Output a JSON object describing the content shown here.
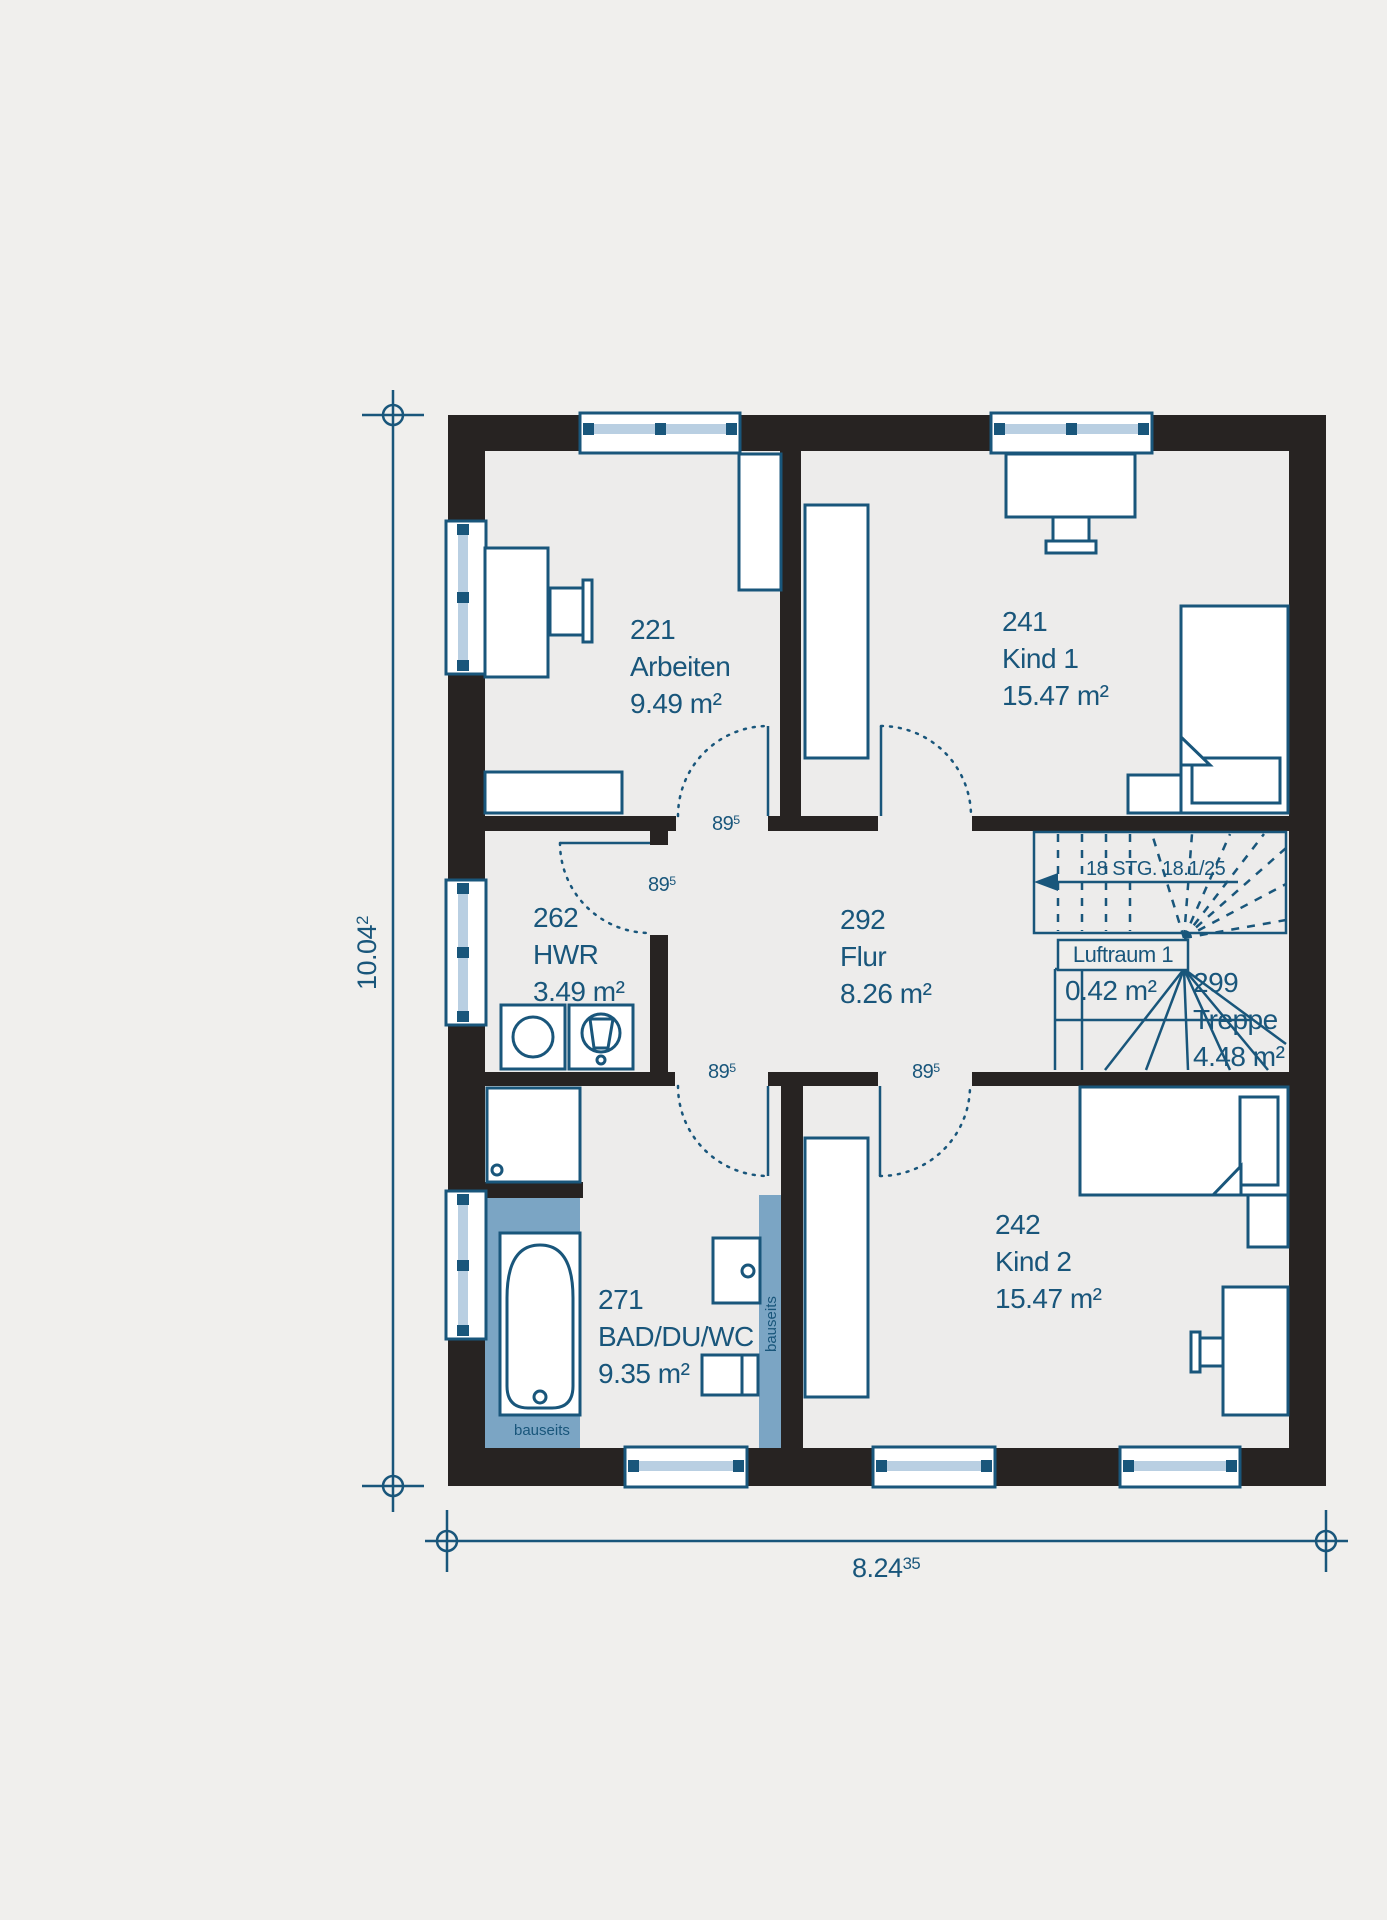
{
  "colors": {
    "accent_blue": "#19567b",
    "wall_black": "#272322",
    "window_glass": "#b9cfe2",
    "bauseits_blue": "#7ba5c4",
    "background": "#f0efed",
    "floor": "#edeceb"
  },
  "rooms": {
    "arbeiten": {
      "number": "221",
      "name": "Arbeiten",
      "area": "9.49 m²"
    },
    "kind1": {
      "number": "241",
      "name": "Kind 1",
      "area": "15.47 m²"
    },
    "hwr": {
      "number": "262",
      "name": "HWR",
      "area": "3.49 m²"
    },
    "flur": {
      "number": "292",
      "name": "Flur",
      "area": "8.26 m²"
    },
    "treppe": {
      "number": "299",
      "name": "Treppe",
      "area": "4.48 m²"
    },
    "bad": {
      "number": "271",
      "name": "BAD/DU/WC",
      "area": "9.35 m²"
    },
    "kind2": {
      "number": "242",
      "name": "Kind 2",
      "area": "15.47 m²"
    }
  },
  "void_space": {
    "name": "Luftraum 1",
    "area": "0.42 m²"
  },
  "stairs": {
    "label": "18 STG. 18.1/25"
  },
  "door_width": {
    "main": "89",
    "sup": "5"
  },
  "notes": {
    "bauseits": "bauseits"
  },
  "dimensions": {
    "height": {
      "main": "10.04",
      "sup": "2"
    },
    "width": {
      "main": "8.24",
      "sup": "35"
    }
  }
}
